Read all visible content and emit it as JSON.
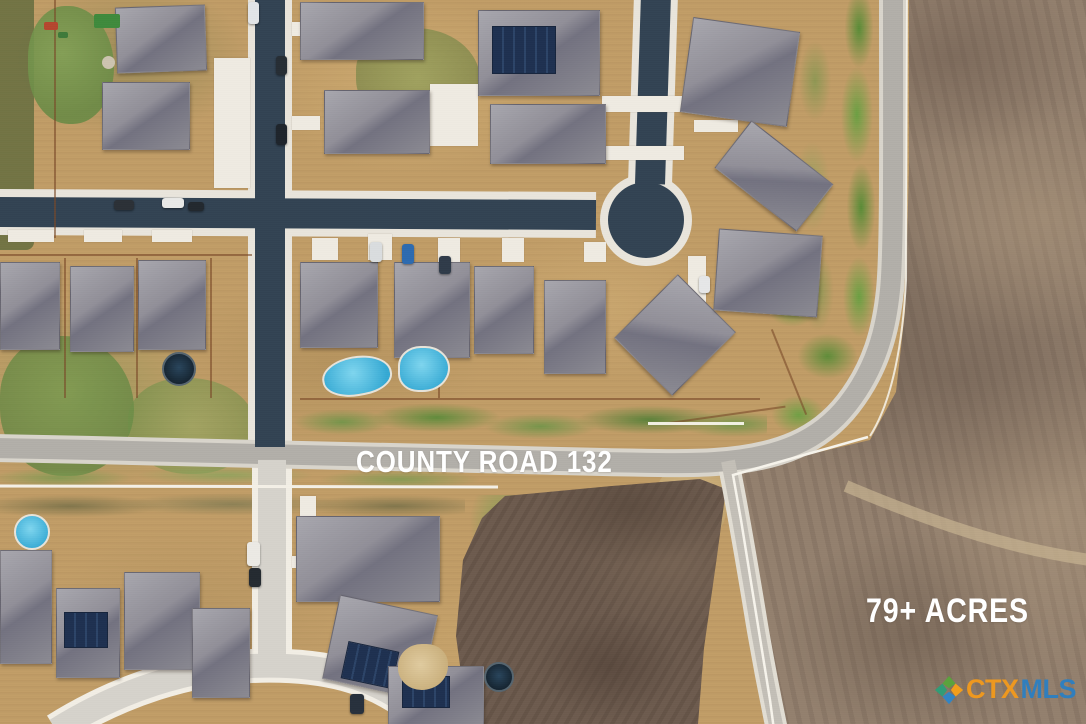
{
  "image": {
    "kind": "aerial-drone-photo",
    "subject": "suburban subdivision beside vacant farmland for sale"
  },
  "overlays": {
    "road_label": "COUNTY ROAD 132",
    "acreage_label": "79+ ACRES",
    "label_color": "#ffffff"
  },
  "logo": {
    "name": "CTXMLS watermark",
    "text_ctx": "CTX",
    "text_mls": "MLS",
    "ctx_color": "#f29a1d",
    "mls_color": "#2d7fc1",
    "icon": "texas-pinwheel-icon",
    "icon_colors": [
      "#5aa53c",
      "#f6a01a",
      "#2f86c8",
      "#2e9e77"
    ]
  },
  "palette": {
    "asphalt_street": "#324353",
    "county_road": "#b2afa9",
    "concrete": "#efebe2",
    "yard_tan": "#c19d67",
    "grass_green": "#6f9448",
    "field_brown": "#93806e",
    "plowed_dark": "#6d5b4e",
    "roof_gray": "#8b8a92",
    "pool_blue": "#35a9d4"
  }
}
